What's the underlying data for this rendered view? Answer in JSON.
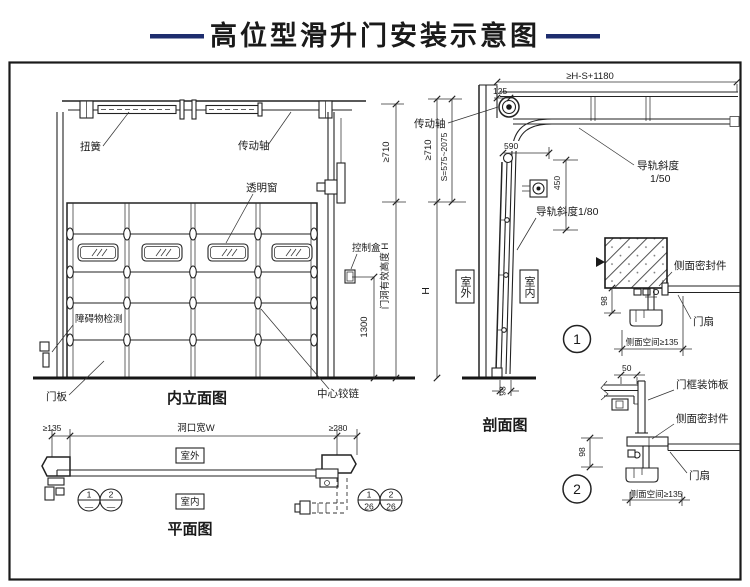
{
  "title": "高位型滑升门安装示意图",
  "colors": {
    "accent": "#1e2d6e",
    "line": "#222222"
  },
  "elevation": {
    "caption": "内立面图",
    "torsion_spring": "扭簧",
    "drive_shaft": "传动轴",
    "window": "透明窗",
    "control_box": "控制盒",
    "obstacle_detect": "障碍物检测",
    "door_panel": "门板",
    "center_hinge": "中心铰链",
    "dim_1300": "1300",
    "dim_opening_height": "门洞有效高度 H",
    "dim_710": "≥710"
  },
  "section": {
    "caption": "剖面图",
    "drive_shaft": "传动轴",
    "dim_top": "≥H-S+1180",
    "dim_125": "125",
    "dim_710": "≥710",
    "dim_s": "S=575~2075",
    "dim_590": "590",
    "dim_450": "450",
    "dim_h": "H",
    "dim_98": "98",
    "rail_slope_name": "导轨斜度",
    "rail_slope_value": "1/50",
    "rail_slope_80": "导轨斜度1/80",
    "outdoor": "室外",
    "indoor": "室内"
  },
  "detail1": {
    "num": "1",
    "side_seal": "侧面密封件",
    "door_leaf": "门扇",
    "dim_98": "98",
    "dim_side_space": "侧面空间≥135"
  },
  "detail2": {
    "num": "2",
    "frame_panel": "门框装饰板",
    "side_seal": "侧面密封件",
    "door_leaf": "门扇",
    "dim_50": "50",
    "dim_98": "98",
    "dim_side_space": "侧面空间≥135"
  },
  "plan": {
    "caption": "平面图",
    "outdoor": "室外",
    "indoor": "室内",
    "dim_left": "≥135",
    "dim_width": "洞口宽W",
    "dim_right": "≥280",
    "bubbles": [
      {
        "top": "1",
        "bottom": "—"
      },
      {
        "top": "2",
        "bottom": "—"
      },
      {
        "top": "1",
        "bottom": "26"
      },
      {
        "top": "2",
        "bottom": "26"
      }
    ]
  }
}
